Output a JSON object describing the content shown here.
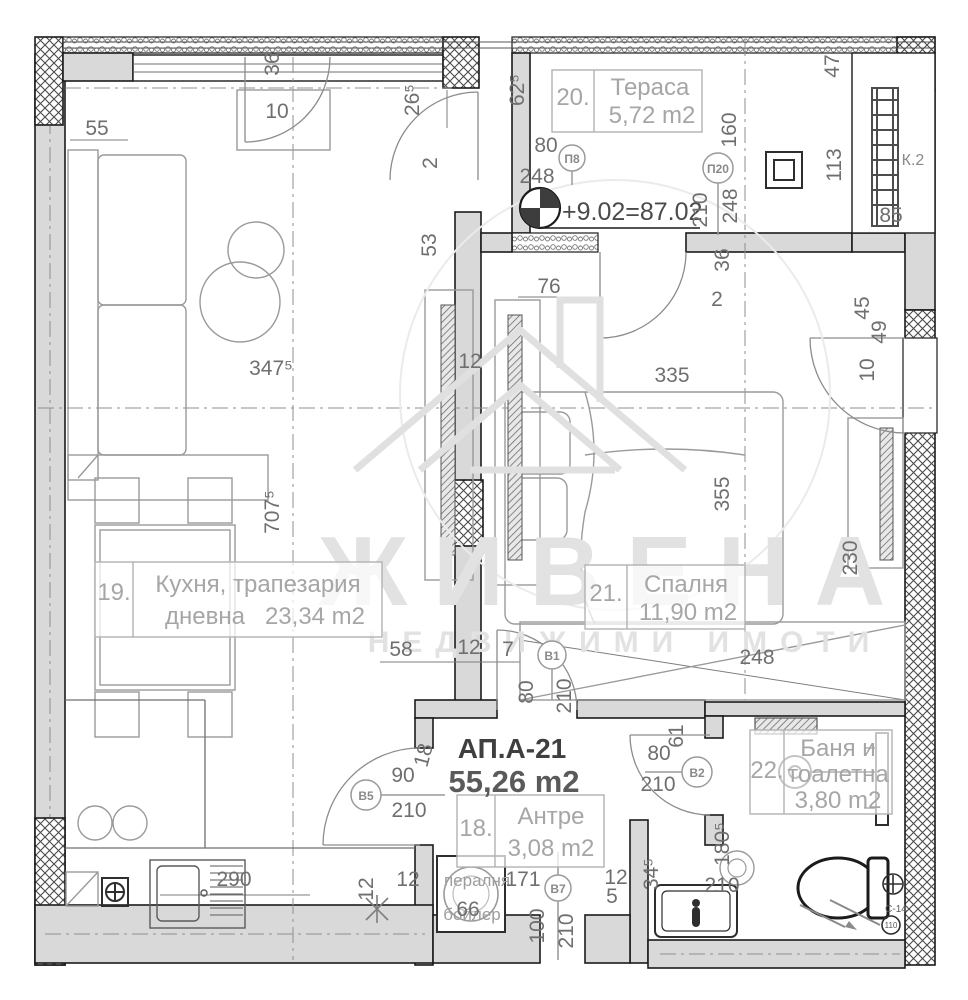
{
  "watermark": {
    "brand": "ЖИВЕНА",
    "subtitle": "НЕДВИЖИМИ ИМОТИ"
  },
  "apartment": {
    "code": "АП.А-21",
    "total_area": "55,26 m2",
    "level_mark": "+9.02=87.02"
  },
  "rooms": {
    "terrace": {
      "num": "20.",
      "name": "Тераса",
      "area": "5,72 m2"
    },
    "kitchen": {
      "num": "19.",
      "name_line1": "Кухня, трапезария",
      "name_line2": "дневна",
      "area": "23,34 m2"
    },
    "bedroom": {
      "num": "21.",
      "name": "Спалня",
      "area": "11,90 m2"
    },
    "hall": {
      "num": "18.",
      "name": "Антре",
      "area": "3,08 m2"
    },
    "bath": {
      "num": "22.",
      "name_line1": "Баня и",
      "name_line2": "тоалетна",
      "area": "3,80 m2"
    }
  },
  "door_marks": {
    "p8": "П8",
    "p20": "П20",
    "b1": "B1",
    "b2": "B2",
    "b5": "B5",
    "b7": "B7"
  },
  "shaft_label": "К.2",
  "drain": {
    "code": "С-14",
    "diameter": "110"
  },
  "appliances": {
    "washer": "пералня",
    "boiler": "бойлер"
  },
  "colors": {
    "wall_fill": "#d9d9d9",
    "line": "#1b1b1b",
    "dim_text": "#6f6f6f",
    "room_text": "#a6a6a6",
    "watermark": "#e2e2e2"
  },
  "dims": {
    "tl_36": "36",
    "tl_10": "10",
    "tl_55": "55",
    "tl_265": "26⁵",
    "tl_door2": "2",
    "tl_53": "53",
    "tl_625": "62⁵",
    "p8_w": "80",
    "p8_h": "248",
    "ter_160": "160",
    "p20_w": "210",
    "p20_h": "248",
    "ter_36": "36",
    "ter_47": "47",
    "ter_113": "113",
    "ter_85": "85",
    "kit_76": "76",
    "bed_door2": "2",
    "bed_335": "335",
    "kit_3475": "347⁵",
    "bed_45": "45",
    "bed_49": "49",
    "bed_10": "10",
    "kit_7075": "707⁵",
    "bed_355": "355",
    "bed_230": "230",
    "rad_12": "12",
    "kit_58": "58",
    "kit_12": "12",
    "kit_7": "7",
    "bed_248": "248",
    "b1_w": "80",
    "b1_h": "210",
    "bath_61": "61",
    "b2_w": "80",
    "b2_h": "210",
    "b5_w": "90",
    "b5_h": "210",
    "hall_18": "18",
    "bath_1805": "180⁵",
    "bath_345": "34⁵",
    "bath_12": "12",
    "bath_5": "5",
    "hall_171": "171",
    "hall_66": "66",
    "kit_290": "290",
    "hall_12a": "12",
    "hall_12b": "12",
    "b7_w": "100",
    "b7_h": "210",
    "bath_210": "210"
  }
}
